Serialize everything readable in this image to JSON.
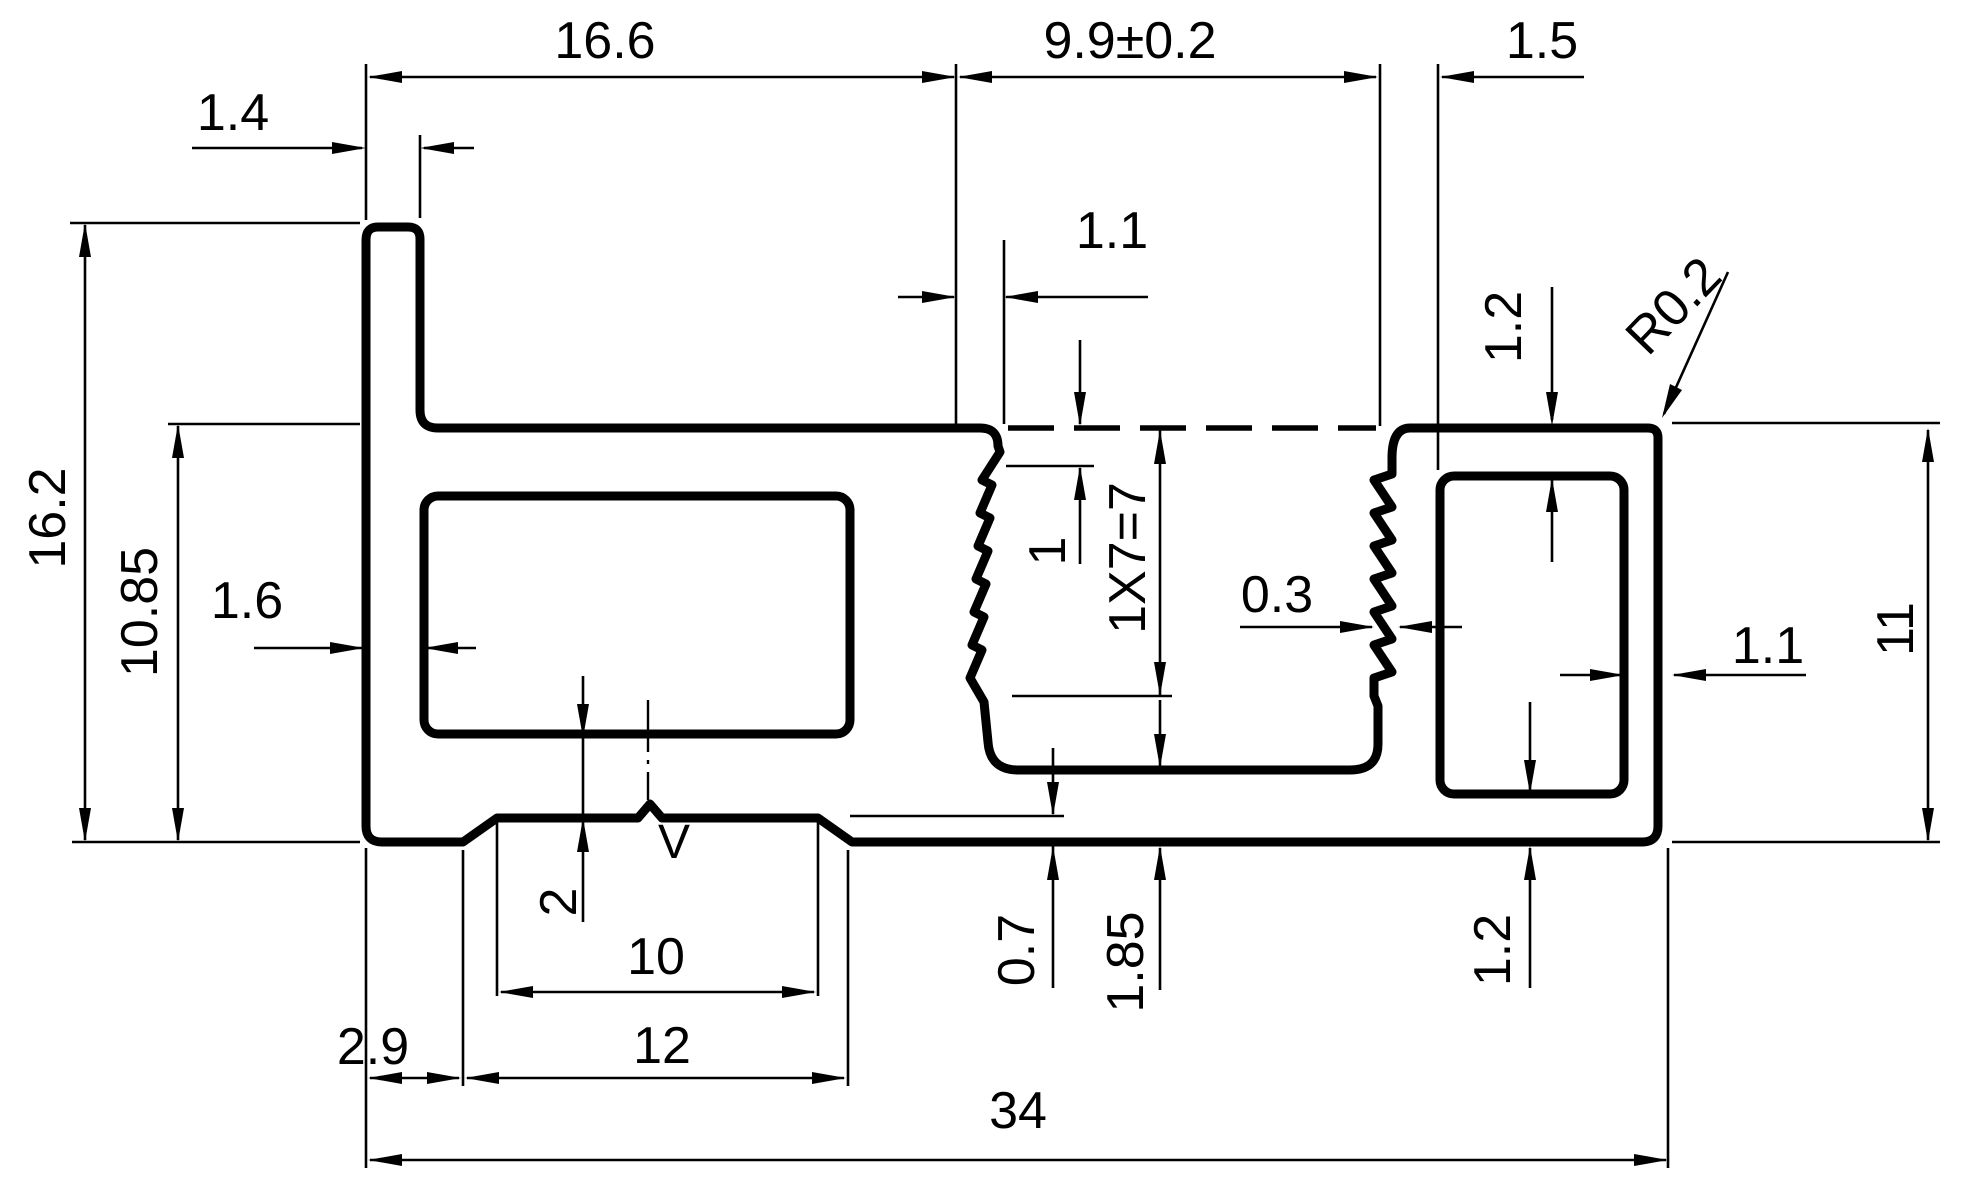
{
  "drawing": {
    "type": "extrusion-profile-cross-section",
    "surface_mark": "V"
  },
  "dimensions": {
    "tab_thickness": "1.4",
    "flange_span": "16.6",
    "channel_span": "9.9±0.2",
    "rib_offset": "1.5",
    "lip_thickness": "1.1",
    "top_wall_right": "1.2",
    "corner_radius": "R0.2",
    "overall_height": "16.2",
    "body_height": "10.85",
    "left_wall": "1.6",
    "serration_pitch": "1",
    "serration_formula": "1X7=7",
    "serration_depth": "0.3",
    "right_wall": "1.1",
    "right_height": "11",
    "bottom_wall_left": "2",
    "recess_step": "0.7",
    "channel_floor": "1.85",
    "bottom_wall_right": "1.2",
    "left_foot": "2.9",
    "recess_width": "10",
    "foot_span": "12",
    "overall_width": "34"
  }
}
